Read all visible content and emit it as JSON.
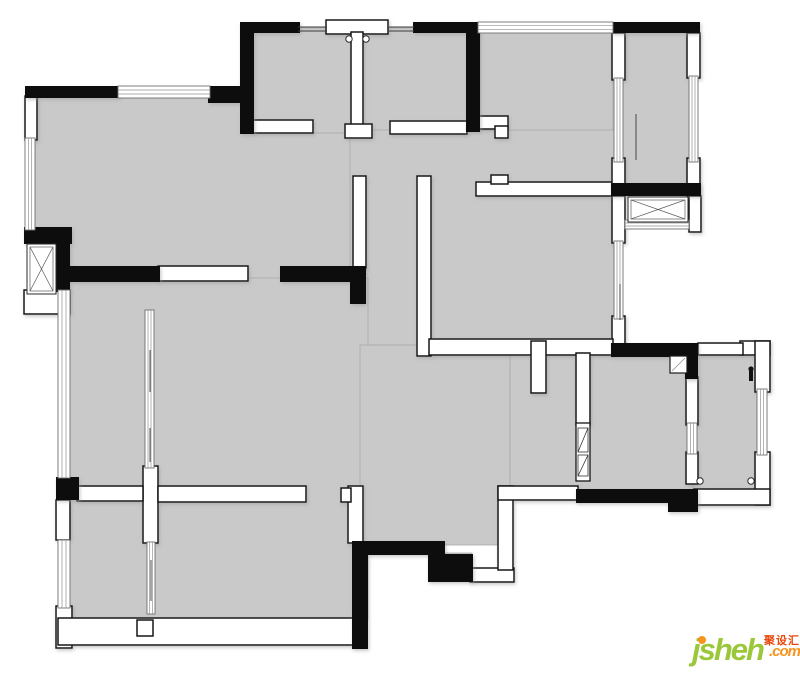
{
  "canvas": {
    "width": 800,
    "height": 674,
    "background": "#ffffff"
  },
  "colors": {
    "floor": "#c9c9c9",
    "floor_edge": "#aaaaaa",
    "wall_black": "#0d0d0d",
    "wall_white_fill": "#ffffff",
    "wall_white_stroke": "#161616",
    "window_stroke": "#707070",
    "window_line": "#909090",
    "detail_line": "#3a3a3a",
    "shadow": "#9a9a9a"
  },
  "watermark": {
    "logo": "jsheh",
    "cn": "聚设汇",
    "com": ".com",
    "logo_color": "#9bc83b",
    "accent_color": "#f7941d",
    "cn_color": "#e8470e"
  },
  "plan": {
    "floors": [
      [
        30,
        92,
        330,
        188
      ],
      [
        246,
        28,
        234,
        105
      ],
      [
        480,
        28,
        133,
        160
      ],
      [
        619,
        30,
        75,
        158
      ],
      [
        350,
        130,
        270,
        215
      ],
      [
        66,
        278,
        302,
        342
      ],
      [
        360,
        345,
        150,
        200
      ],
      [
        445,
        553,
        27,
        17
      ],
      [
        510,
        345,
        185,
        150
      ],
      [
        693,
        350,
        70,
        145
      ]
    ],
    "white_walls": [
      [
        25,
        96,
        12,
        44
      ],
      [
        252,
        120,
        61,
        13
      ],
      [
        326,
        20,
        62,
        14
      ],
      [
        351,
        32,
        12,
        96
      ],
      [
        345,
        124,
        27,
        14
      ],
      [
        390,
        121,
        77,
        13
      ],
      [
        478,
        116,
        30,
        13
      ],
      [
        495,
        126,
        13,
        12
      ],
      [
        476,
        182,
        138,
        14
      ],
      [
        491,
        175,
        17,
        9
      ],
      [
        612,
        33,
        13,
        47
      ],
      [
        612,
        158,
        13,
        38
      ],
      [
        687,
        33,
        13,
        45
      ],
      [
        687,
        158,
        13,
        38
      ],
      [
        689,
        196,
        12,
        36
      ],
      [
        612,
        196,
        13,
        47
      ],
      [
        612,
        316,
        13,
        29
      ],
      [
        686,
        377,
        12,
        48
      ],
      [
        686,
        452,
        12,
        32
      ],
      [
        353,
        176,
        13,
        92
      ],
      [
        158,
        266,
        90,
        15
      ],
      [
        417,
        176,
        14,
        180
      ],
      [
        429,
        339,
        184,
        16
      ],
      [
        531,
        341,
        15,
        52
      ],
      [
        576,
        353,
        14,
        72
      ],
      [
        143,
        466,
        15,
        77
      ],
      [
        77,
        486,
        66,
        15
      ],
      [
        158,
        486,
        148,
        16
      ],
      [
        56,
        500,
        14,
        40
      ],
      [
        56,
        606,
        16,
        42
      ],
      [
        58,
        618,
        298,
        27
      ],
      [
        137,
        620,
        16,
        16
      ],
      [
        348,
        486,
        15,
        57
      ],
      [
        341,
        488,
        10,
        14
      ],
      [
        470,
        568,
        44,
        14
      ],
      [
        498,
        486,
        15,
        84
      ],
      [
        498,
        486,
        80,
        14
      ],
      [
        740,
        341,
        30,
        14
      ],
      [
        755,
        341,
        15,
        51
      ],
      [
        755,
        452,
        15,
        53
      ],
      [
        694,
        489,
        76,
        16
      ],
      [
        698,
        343,
        45,
        12
      ],
      [
        24,
        290,
        46,
        24
      ]
    ],
    "black_walls": [
      [
        25,
        86,
        95,
        12
      ],
      [
        208,
        86,
        46,
        17
      ],
      [
        240,
        22,
        14,
        112
      ],
      [
        240,
        22,
        60,
        11
      ],
      [
        413,
        22,
        67,
        11
      ],
      [
        466,
        22,
        14,
        110
      ],
      [
        611,
        22,
        89,
        11
      ],
      [
        611,
        183,
        90,
        13
      ],
      [
        611,
        343,
        87,
        14
      ],
      [
        685,
        353,
        13,
        26
      ],
      [
        576,
        489,
        122,
        14
      ],
      [
        668,
        489,
        30,
        23
      ],
      [
        58,
        266,
        102,
        16
      ],
      [
        280,
        266,
        86,
        16
      ],
      [
        350,
        282,
        16,
        22
      ],
      [
        24,
        227,
        48,
        17
      ],
      [
        56,
        243,
        14,
        49
      ],
      [
        56,
        477,
        23,
        23
      ],
      [
        355,
        541,
        90,
        14
      ],
      [
        352,
        541,
        16,
        108
      ],
      [
        428,
        554,
        45,
        28
      ]
    ],
    "windows": [
      {
        "r": [
          118,
          86,
          92,
          12
        ],
        "o": "h"
      },
      {
        "r": [
          25,
          138,
          10,
          92
        ],
        "o": "v"
      },
      {
        "r": [
          58,
          290,
          12,
          188
        ],
        "o": "v"
      },
      {
        "r": [
          58,
          540,
          12,
          68
        ],
        "o": "v"
      },
      {
        "r": [
          478,
          22,
          135,
          11
        ],
        "o": "h"
      },
      {
        "r": [
          614,
          78,
          9,
          84
        ],
        "o": "v"
      },
      {
        "r": [
          689,
          76,
          9,
          86
        ],
        "o": "v"
      },
      {
        "r": [
          614,
          241,
          9,
          78
        ],
        "o": "v"
      },
      {
        "r": [
          687,
          423,
          10,
          31
        ],
        "o": "v"
      },
      {
        "r": [
          757,
          389,
          10,
          66
        ],
        "o": "v"
      },
      {
        "r": [
          145,
          310,
          9,
          158
        ],
        "o": "v"
      },
      {
        "r": [
          147,
          542,
          8,
          72
        ],
        "o": "v"
      },
      {
        "r": [
          625,
          220,
          64,
          9
        ],
        "o": "h"
      }
    ],
    "xboxes": [
      [
        27,
        244,
        29,
        50
      ],
      [
        628,
        197,
        60,
        25
      ]
    ],
    "hatch_base": [
      576,
      423,
      14,
      58
    ],
    "hatch_boxes": [
      [
        578,
        428,
        10,
        24
      ],
      [
        578,
        455,
        10,
        21
      ]
    ],
    "door_leaves": [
      [
        670,
        356,
        17,
        17
      ]
    ],
    "detail_lines": [
      [
        298,
        27,
        327,
        27
      ],
      [
        298,
        31,
        327,
        31
      ],
      [
        389,
        27,
        414,
        27
      ],
      [
        389,
        31,
        414,
        31
      ],
      [
        636,
        114,
        636,
        160
      ],
      [
        150,
        350,
        150,
        392
      ],
      [
        150,
        428,
        150,
        462
      ],
      [
        151,
        560,
        151,
        601
      ],
      [
        620,
        284,
        620,
        320
      ]
    ],
    "dots": [
      [
        349,
        39
      ],
      [
        366,
        39
      ],
      [
        700,
        481
      ],
      [
        751,
        481
      ]
    ],
    "lamp_marks": [
      [
        751,
        369
      ]
    ]
  }
}
